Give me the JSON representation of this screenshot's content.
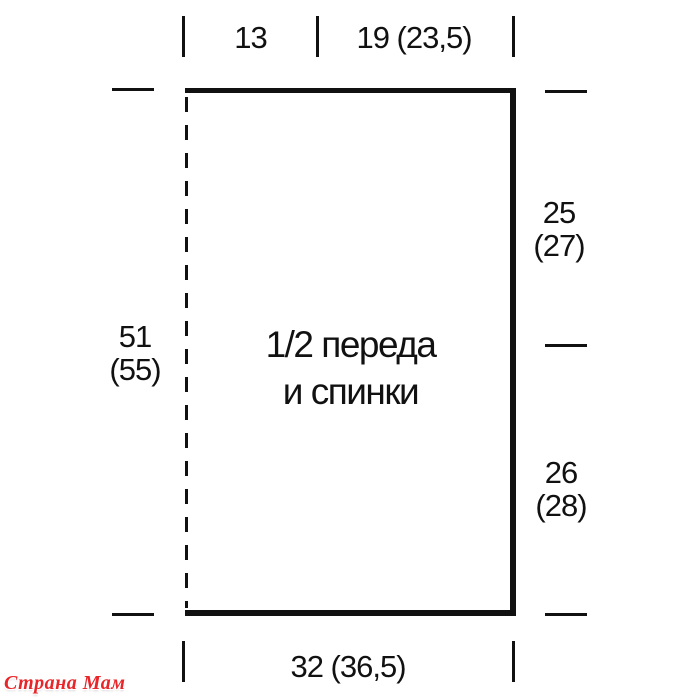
{
  "colors": {
    "ink": "#111111",
    "background": "#ffffff",
    "watermark_red": "#e8262a"
  },
  "diagram": {
    "piece_label": {
      "line1": "1/2 переда",
      "line2": "и спинки"
    },
    "measurements": {
      "top_segment_1": "13",
      "top_segment_2": "19 (23,5)",
      "left_height": {
        "line1": "51",
        "line2": "(55)"
      },
      "right_upper": {
        "line1": "25",
        "line2": "(27)"
      },
      "right_lower": {
        "line1": "26",
        "line2": "(28)"
      },
      "bottom_width": "32 (36,5)"
    }
  },
  "watermark": {
    "text": "Страна Мам"
  }
}
